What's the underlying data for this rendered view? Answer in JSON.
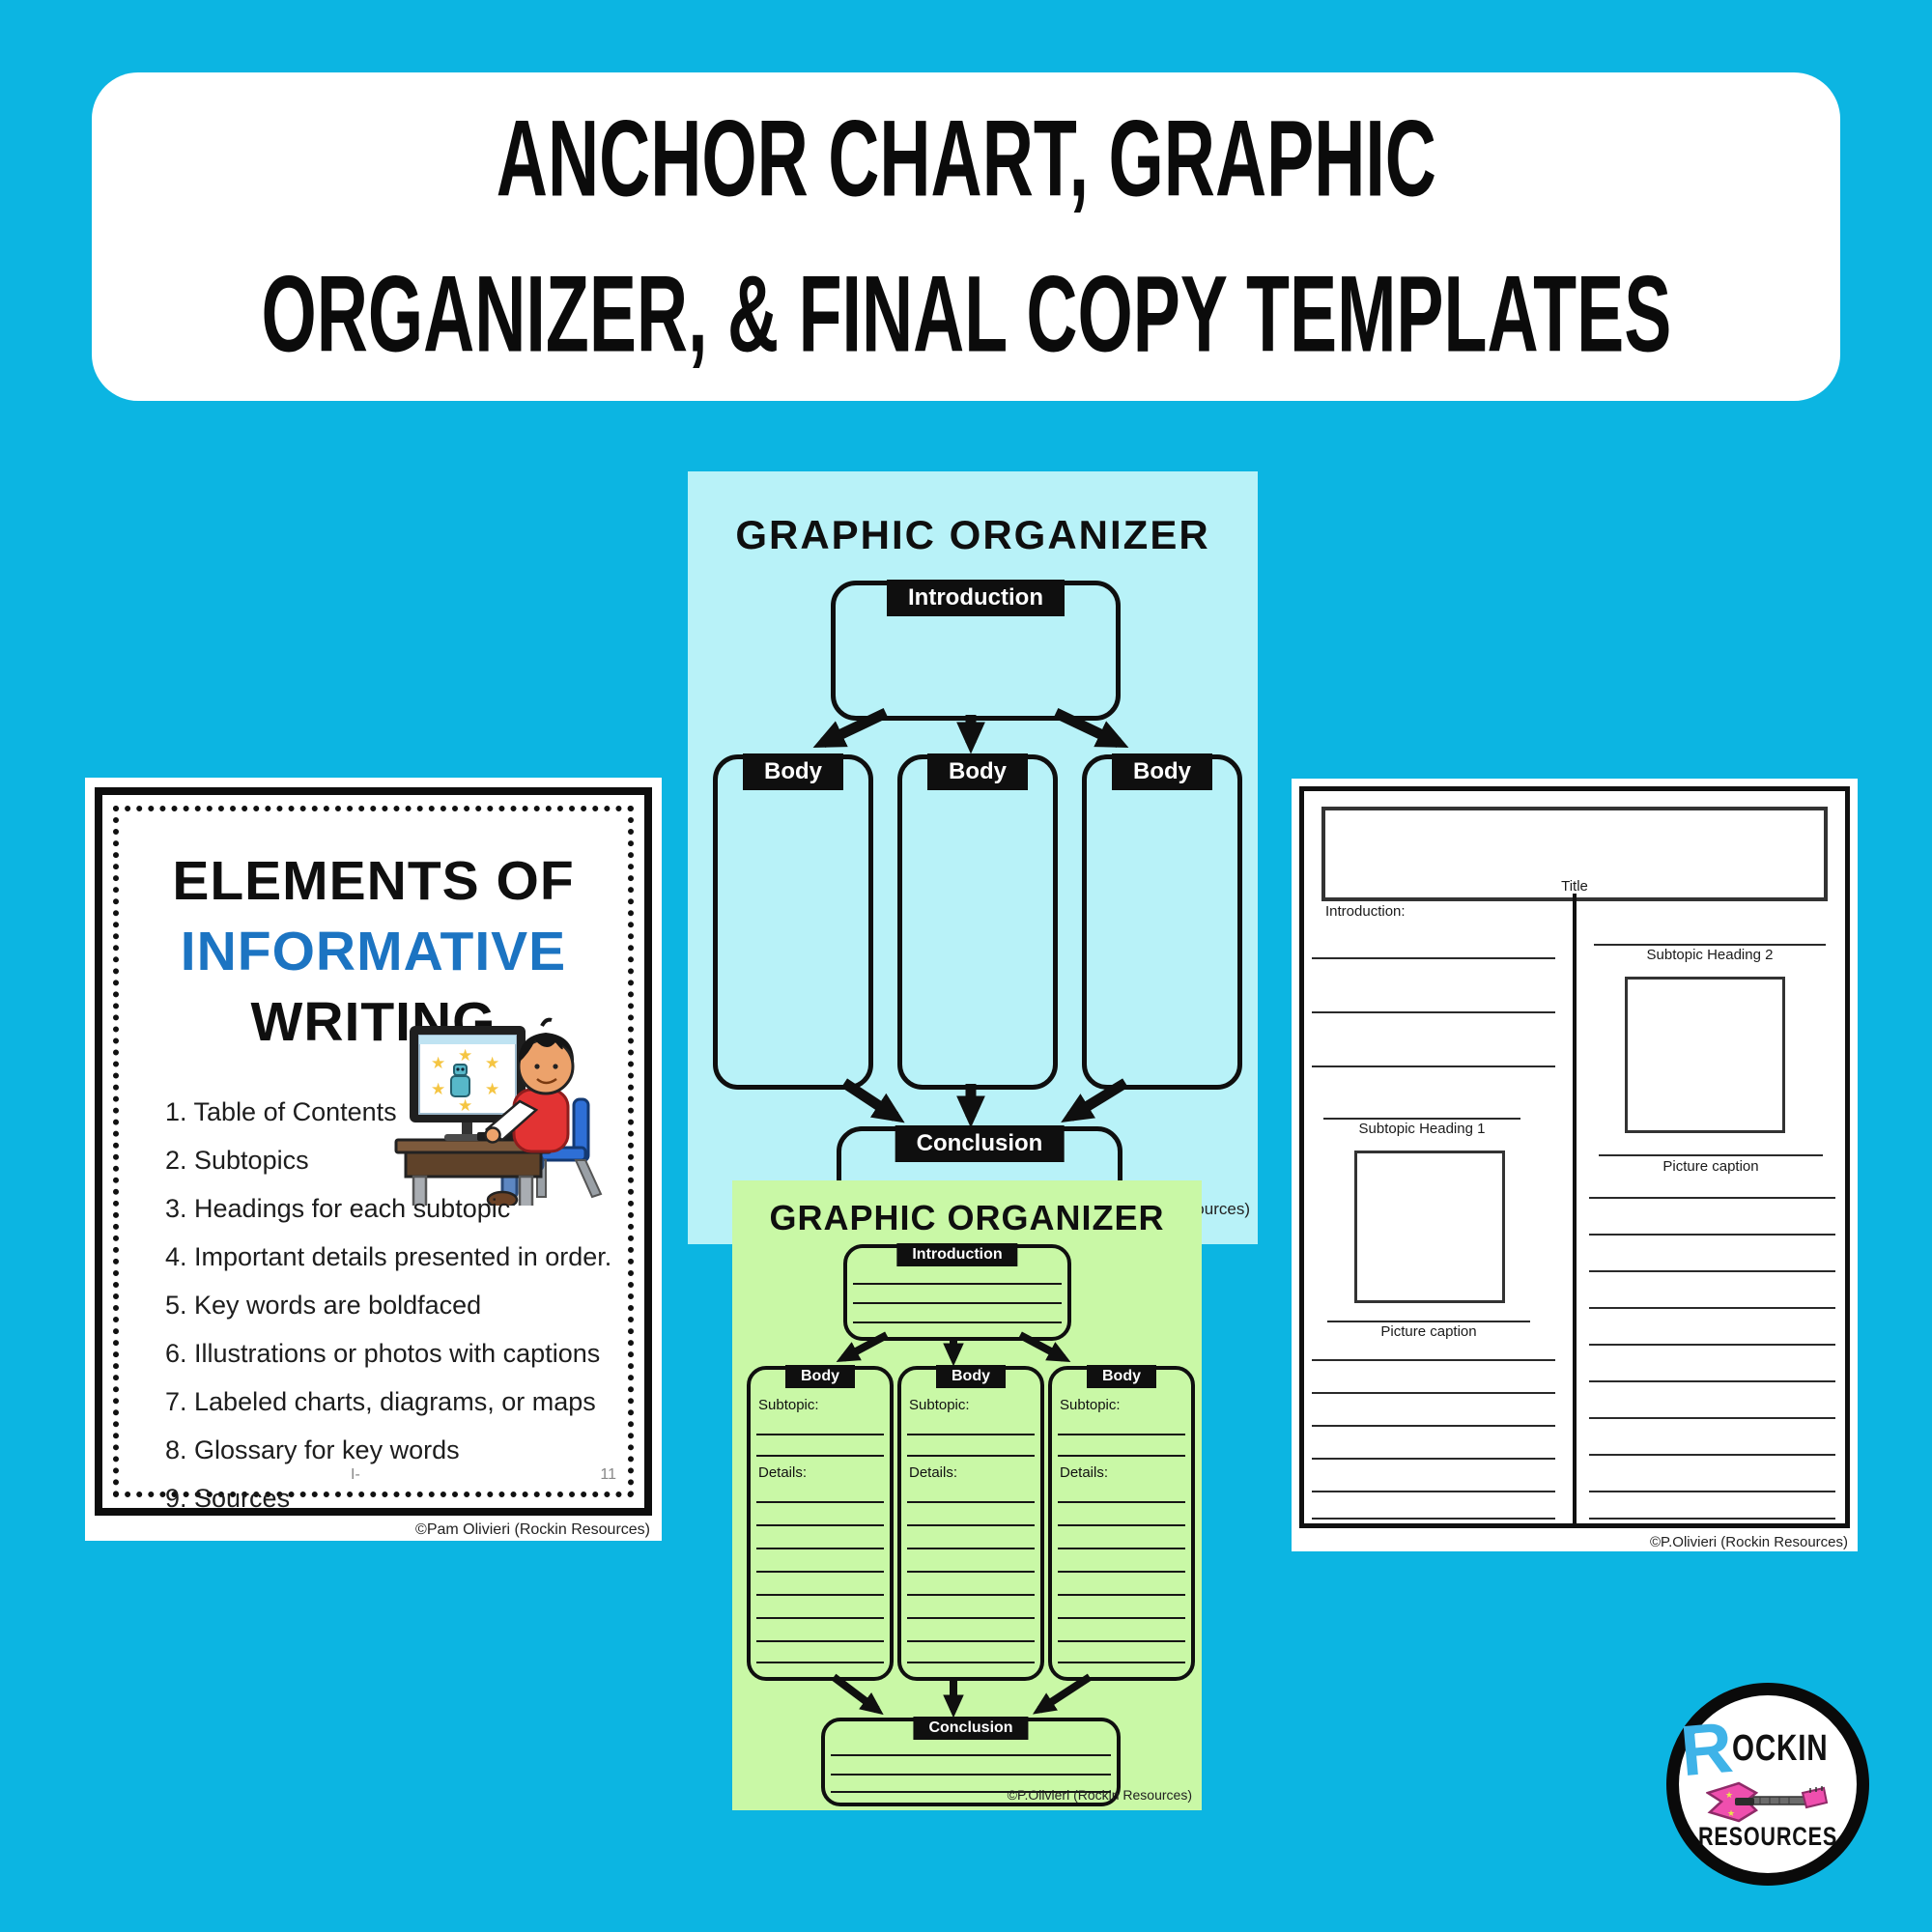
{
  "banner": {
    "line1": "ANCHOR CHART, GRAPHIC",
    "line2": "ORGANIZER, & FINAL COPY TEMPLATES"
  },
  "anchor_chart": {
    "title_line1": "ELEMENTS OF",
    "title_line2": "INFORMATIVE",
    "title_line3": "WRITING",
    "items": [
      "1. Table of Contents",
      "2. Subtopics",
      "3. Headings for each subtopic",
      "4. Important details presented in order.",
      "5. Key words are boldfaced",
      "6. Illustrations or photos with captions",
      "7. Labeled charts, diagrams, or maps",
      "8. Glossary for key words",
      "9. Sources"
    ],
    "footer_left": "I-",
    "footer_page": "11",
    "copyright": "©Pam Olivieri (Rockin Resources)"
  },
  "organizer_cyan": {
    "title": "GRAPHIC ORGANIZER",
    "intro_label": "Introduction",
    "body_labels": [
      "Body",
      "Body",
      "Body"
    ],
    "conclusion_label": "Conclusion",
    "copyright": "©P.Olivieri (Rockin Resources)"
  },
  "organizer_green": {
    "title": "GRAPHIC ORGANIZER",
    "intro_label": "Introduction",
    "body_labels": [
      "Body",
      "Body",
      "Body"
    ],
    "subtopic_label": "Subtopic:",
    "details_label": "Details:",
    "conclusion_label": "Conclusion",
    "copyright": "©P.Olivieri (Rockin Resources)"
  },
  "final_template": {
    "title_label": "Title",
    "introduction_label": "Introduction:",
    "subtopic_heading_1": "Subtopic Heading 1",
    "subtopic_heading_2": "Subtopic Heading 2",
    "picture_caption_1": "Picture caption",
    "picture_caption_2": "Picture caption",
    "copyright": "©P.Olivieri (Rockin Resources)"
  },
  "logo": {
    "r": "R",
    "ockin": "OCKIN",
    "resources": "RESOURCES"
  },
  "colors": {
    "background": "#0cb5e2",
    "cyan_page": "#b8f2f8",
    "green_page": "#c9f8a6",
    "informative_blue": "#1c74c2",
    "logo_blue": "#3fb3e8",
    "guitar_pink": "#ef4fae",
    "label_bg": "#0f0f0f"
  }
}
